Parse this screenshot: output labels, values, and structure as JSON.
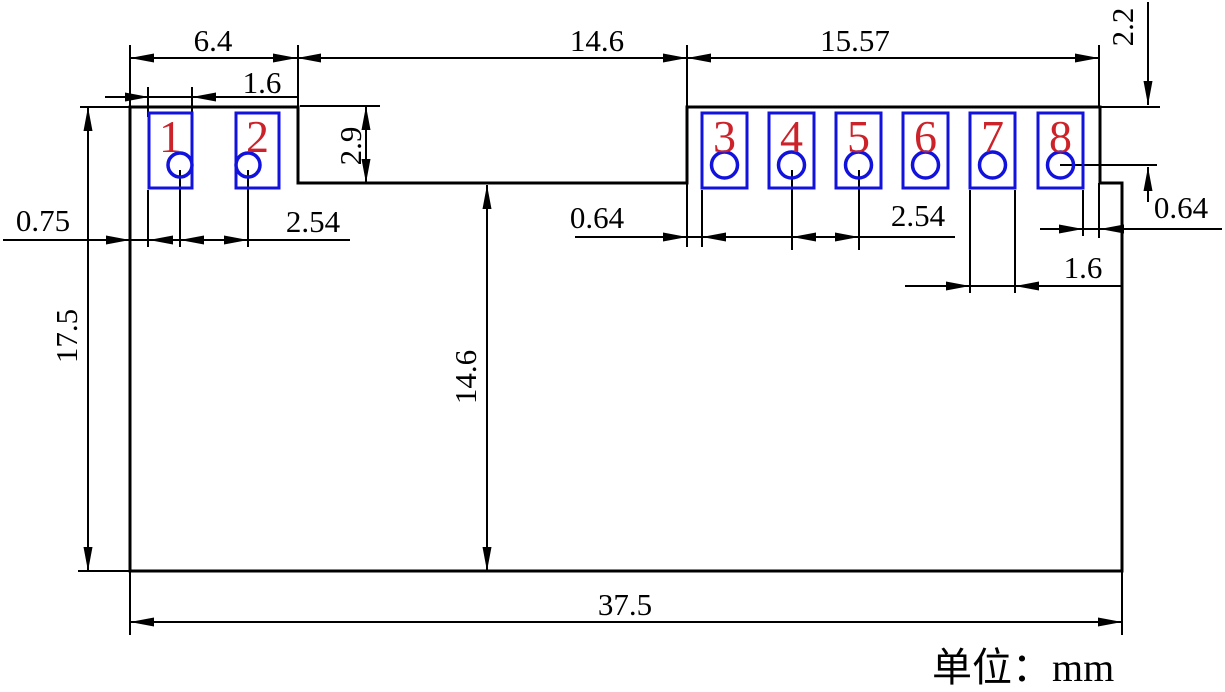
{
  "dims": {
    "width_left_section": "6.4",
    "width_middle_notch": "14.6",
    "width_right_section": "15.57",
    "pad1_width": "1.6",
    "notch_depth": "2.9",
    "top_right_offset": "2.2",
    "edge_to_pad1": "0.75",
    "pads12_pitch": "2.54",
    "gap_notch_to_pad3": "0.64",
    "pads45_pitch": "2.54",
    "hole8_to_step": "0.64",
    "pad7_width": "1.6",
    "overall_height": "17.5",
    "notch_bottom_height": "14.6",
    "overall_width": "37.5"
  },
  "unit_label": "单位：mm",
  "pads": [
    "1",
    "2",
    "3",
    "4",
    "5",
    "6",
    "7",
    "8"
  ],
  "colors": {
    "line": "#000000",
    "pad_outline": "#1212dd",
    "pad_number": "#cc2229"
  }
}
